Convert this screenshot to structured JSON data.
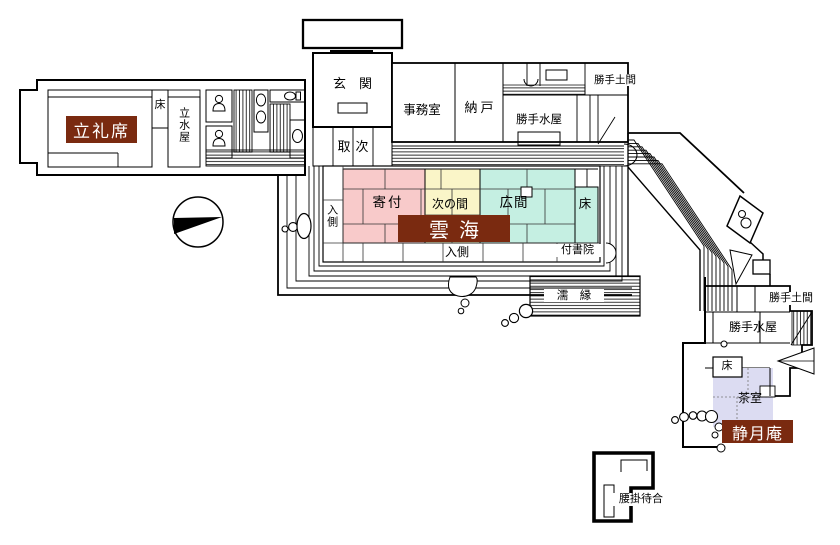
{
  "document": {
    "type": "floor-plan",
    "background": "#ffffff"
  },
  "colors": {
    "plate_bg": "#7a2a10",
    "plate_text": "#ffffff",
    "room_pink": "#f8caca",
    "room_yellow": "#faf5c8",
    "room_cyan": "#c5efe2",
    "room_lavender": "#dcdcf2",
    "wall": "#000000",
    "white": "#ffffff"
  },
  "plates": {
    "ritsureiseki": "立礼席",
    "unkai": "雲海",
    "seigetsuan": "静月庵"
  },
  "rooms": {
    "toko_left": "床",
    "tachimizuya": "立水屋",
    "genkan": "玄　関",
    "toritsugi": "取次",
    "jimushitsu": "事務室",
    "nando": "納戸",
    "katte_doma_top": "勝手土間",
    "katte_mizuya_top": "勝手水屋",
    "irikawa_left": "入側",
    "yoritsuki": "寄付",
    "tsugi_no_ma": "次の間",
    "hiroma": "広間",
    "toko_main": "床",
    "irikawa_bottom": "入側",
    "tsukeshoin": "付書院",
    "nure_en": "濡　縁",
    "katte_doma_east": "勝手土間",
    "katte_mizuya_east": "勝手水屋",
    "toko_east": "床",
    "chashitsu": "茶室",
    "koshikake_machiai": "腰掛待合"
  }
}
